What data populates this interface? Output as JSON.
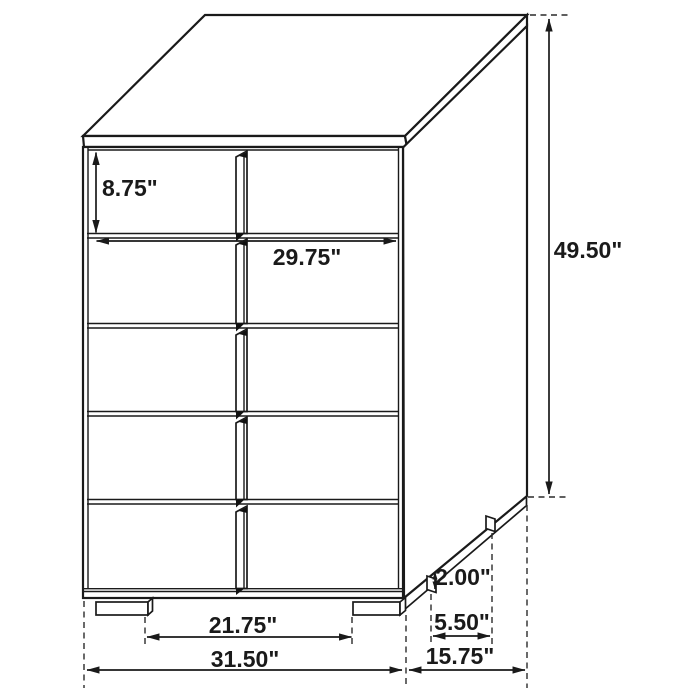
{
  "diagram": {
    "type": "furniture-dimension-drawing",
    "subject": "5-drawer chest",
    "colors": {
      "line": "#1a1a1a",
      "background": "#ffffff"
    },
    "dimensions": {
      "top_drawer_height": "8.75\"",
      "drawer_width": "29.75\"",
      "overall_height": "49.50\"",
      "foot_height": "2.00\"",
      "side_foot_depth": "5.50\"",
      "overall_depth": "15.75\"",
      "front_feet_spacing": "21.75\"",
      "overall_width": "31.50\""
    }
  }
}
